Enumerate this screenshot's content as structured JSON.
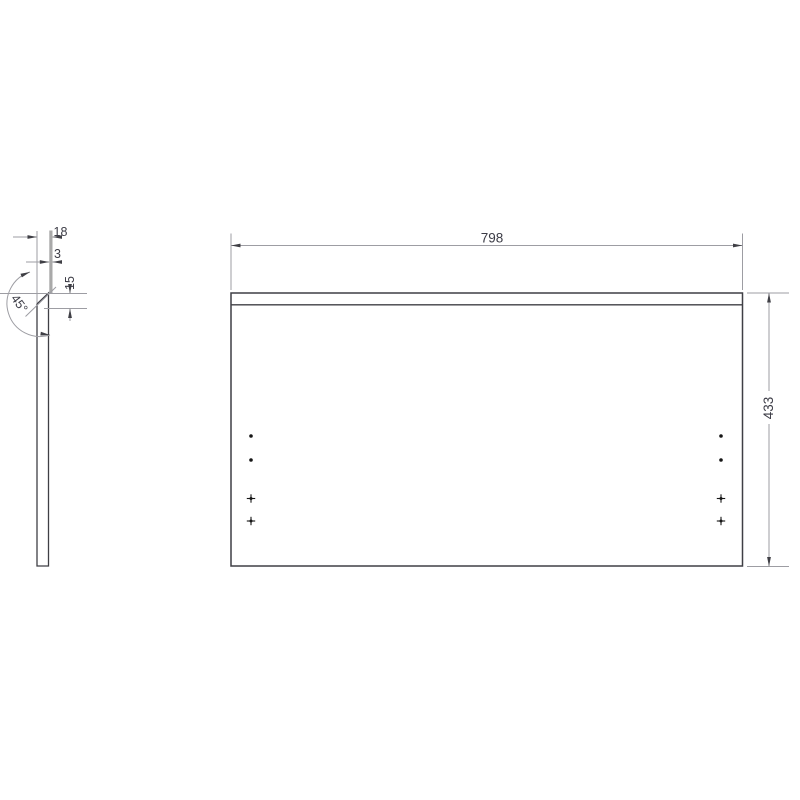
{
  "drawing": {
    "type": "technical-panel-drawing",
    "views": {
      "side": {
        "name": "side profile view",
        "dims": {
          "thickness": "18",
          "front_edge": "3",
          "chamfer_height": "15",
          "chamfer_angle": "45°"
        }
      },
      "front": {
        "name": "front view",
        "dims": {
          "width": "798",
          "height": "433"
        },
        "hole_markers": {
          "round_dots_left": 2,
          "round_dots_right": 2,
          "cross_marks_left": 2,
          "cross_marks_right": 2
        }
      }
    },
    "colors": {
      "object_line": "#3f3f45",
      "dimension_line": "#9d9da3",
      "edge_band": "#a9a9a9",
      "text": "#3c3c46",
      "hole_marker": "#161616",
      "background": "#ffffff"
    }
  }
}
